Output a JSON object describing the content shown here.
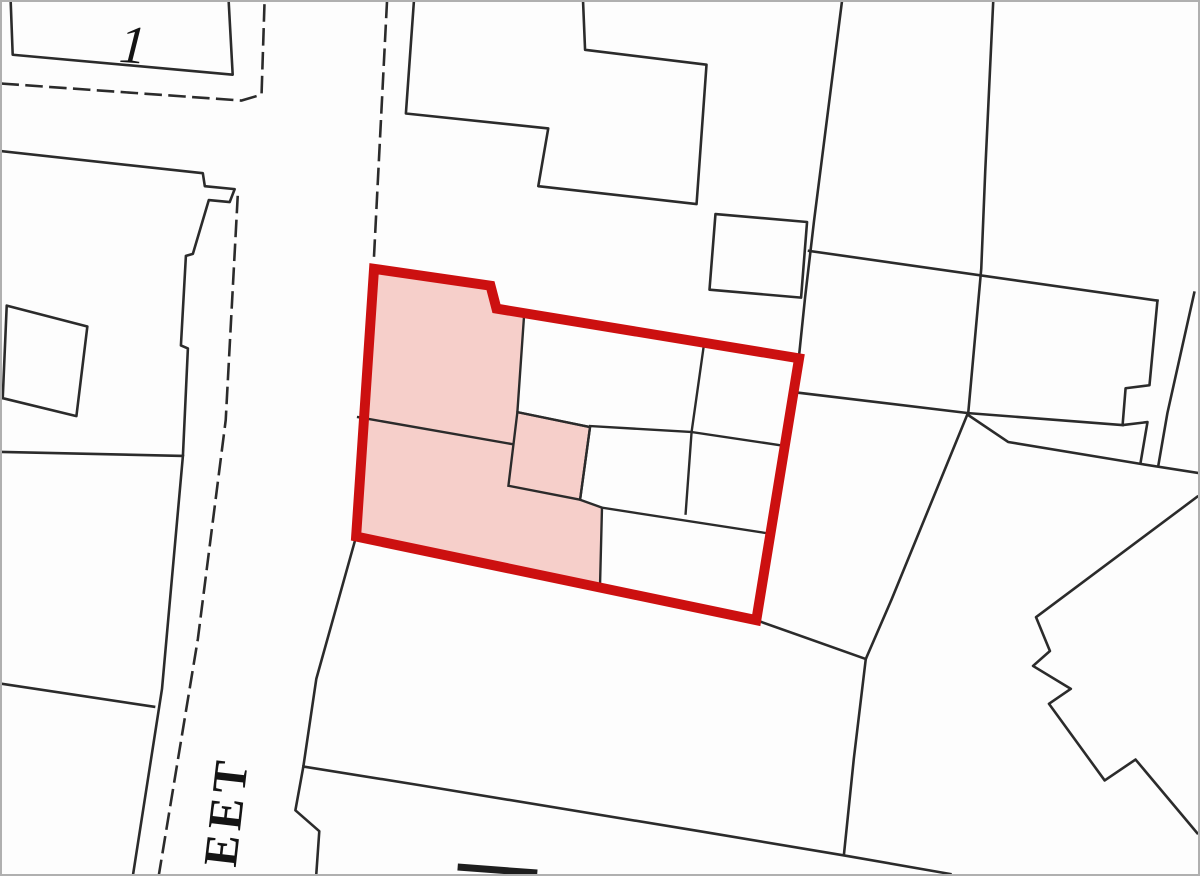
{
  "map": {
    "labels": {
      "house_number": "1",
      "street_name_fragment": "EET"
    }
  },
  "colors": {
    "site_boundary_red": "#cc1010",
    "site_building_pink": "#f6cfca",
    "map_line": "#2b2b2b",
    "map_background": "#fdfdfd",
    "frame_border": "#b0b0b0",
    "label_text": "#141414"
  }
}
